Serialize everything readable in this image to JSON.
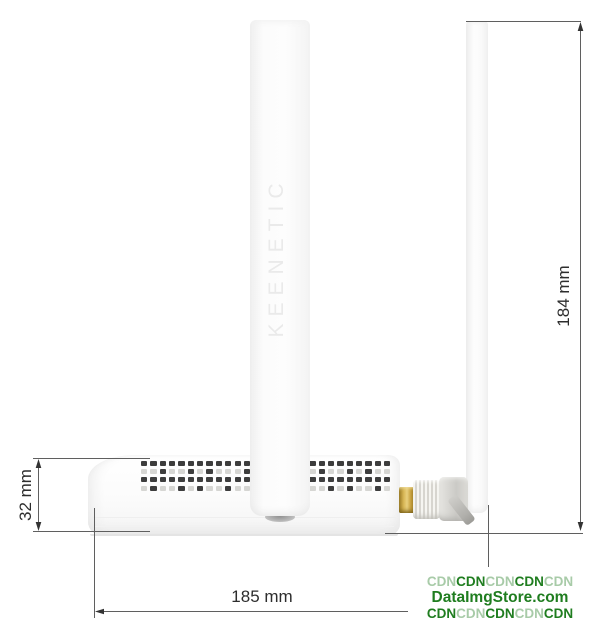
{
  "figure": {
    "device_brand_embossed": "KEENETIC"
  },
  "dimensions": {
    "overall_height": "184 mm",
    "body_height": "32 mm",
    "overall_width": "185 mm"
  },
  "watermark": {
    "colors": {
      "dark": "#1f7d1f",
      "light": "#a8cba8"
    },
    "lines": [
      {
        "large": false,
        "segments": [
          [
            "CDN",
            "light"
          ],
          [
            "CDN",
            "dark"
          ],
          [
            "CDN",
            "light"
          ],
          [
            "CDN",
            "dark"
          ],
          [
            "CDN",
            "light"
          ]
        ]
      },
      {
        "large": true,
        "segments": [
          [
            "DataImgStore.com",
            "dark"
          ]
        ]
      },
      {
        "large": false,
        "segments": [
          [
            "CDN",
            "dark"
          ],
          [
            "CDN",
            "light"
          ],
          [
            "CDN",
            "dark"
          ],
          [
            "CDN",
            "light"
          ],
          [
            "CDN",
            "dark"
          ]
        ]
      }
    ]
  },
  "vents": {
    "dark": "#3d3d3d",
    "light": "#d6d6d3",
    "patterns": [
      "DDDDDDDDDDDDDDDDDDDDDDDDDDD",
      "LLDLLDLDLLLDLLDLDLLDLLDLDLL",
      "DDDDDDDDDDDDDDDDDDDDDDDDDDD",
      "LDLLDLDLLDLLDLDLLDLLDLDLLDL"
    ]
  },
  "style": {
    "dimension_line_color": "#5f5f5f",
    "dimension_text_color": "#2d2d2d",
    "gold_connector_color": "#c9a23f",
    "background": "#ffffff"
  }
}
